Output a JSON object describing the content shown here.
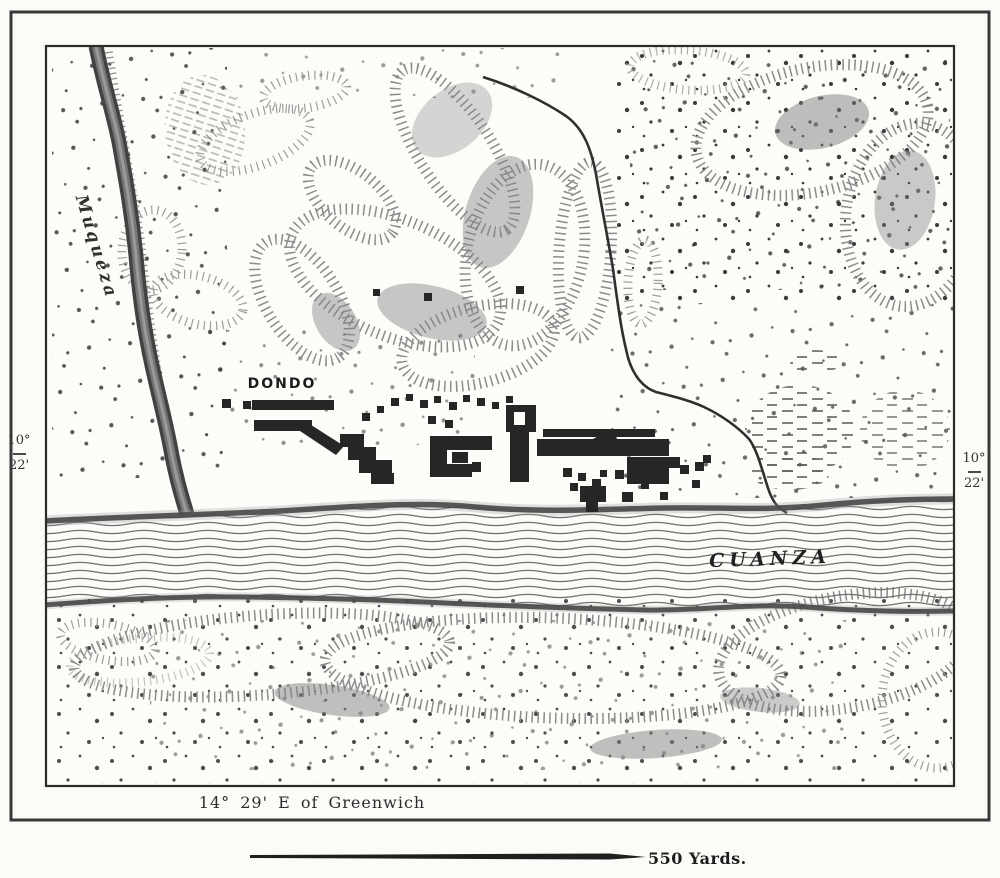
{
  "map": {
    "labels": {
      "town": "DONDO",
      "river_left": "Muqueza",
      "river_main": "CUANZA"
    },
    "graticule": {
      "lat_left": {
        "deg": "10°",
        "min": "22'"
      },
      "lat_right": {
        "deg": "10°",
        "min": "22'"
      },
      "longitude_note": "14° 29' E of Greenwich"
    },
    "scale": {
      "label": "550 Yards."
    },
    "colors": {
      "ink": "#2b2b2b",
      "paper": "#fbfbf8",
      "hatch": "#707070"
    }
  }
}
